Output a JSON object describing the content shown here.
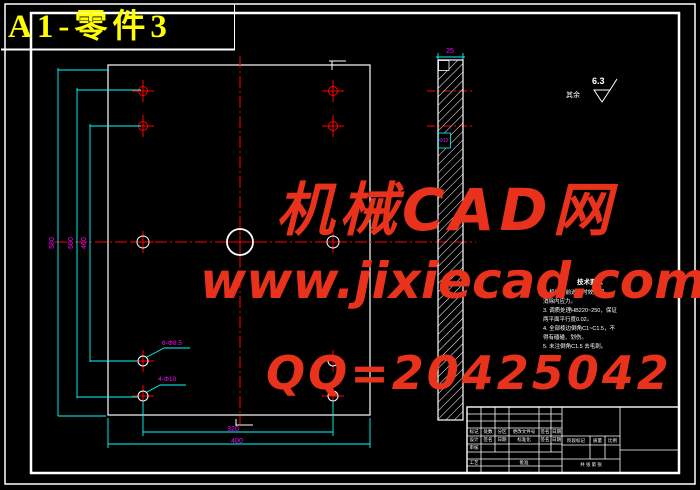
{
  "title": "A1-零件3",
  "watermark": {
    "line1": "机械CAD网",
    "line2": "www.jixiecad.com",
    "line3": "QQ=20425042",
    "color": "#e8321c"
  },
  "colors": {
    "background": "#000000",
    "frame_white": "#ffffff",
    "centerline_red": "#ff0000",
    "dimension_cyan": "#00ffff",
    "dim_text_magenta": "#ff00ff",
    "title_yellow": "#ffff00"
  },
  "roughness": {
    "other_label": "其余",
    "value": "6.3"
  },
  "notes": {
    "title": "技术要求",
    "lines": [
      "1. 机加工前进行时效处理，",
      "   消除内应力。",
      "3. 调质处理HB220~250，保证",
      "   两平面平行度0.02。",
      "4. 全部棱边倒角C1~C1.5，不",
      "   得有磕碰、划伤。",
      "5. 未注倒角C1.5 去毛刺。"
    ]
  },
  "dimensions": {
    "left_vertical": [
      "580",
      "500",
      "460"
    ],
    "bottom": [
      "320",
      "400"
    ],
    "section_top": "25",
    "section_notch": "Φ12",
    "hole_callout_1": "6-Φ8.5",
    "hole_callout_2": "4-Φ10"
  },
  "title_block": {
    "rev_headers": [
      "标记",
      "处数",
      "分区",
      "更改文件号",
      "签名",
      "日期"
    ],
    "design": "设计",
    "check": "审核",
    "process": "工艺",
    "standardize": "标准化",
    "approve": "批准",
    "sig": "签名",
    "date": "日期",
    "stage": "阶段标记",
    "weight": "质量",
    "scale": "比例",
    "sheet_info": "共  张  第  张"
  }
}
